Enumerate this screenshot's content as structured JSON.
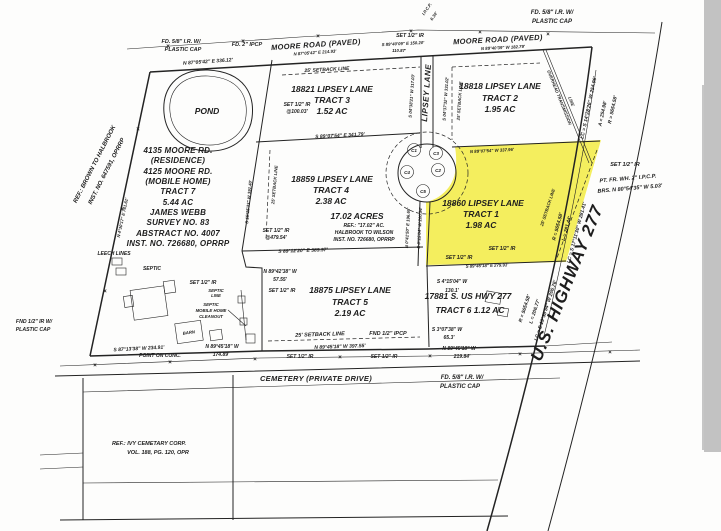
{
  "colors": {
    "highlight": "#f4ee5e",
    "ink": "#1d1d1d",
    "scan_edge": "#c2c2c2"
  },
  "glyphs": {
    "fence_x": "×"
  },
  "roads": {
    "moore_left": "MOORE ROAD (PAVED)",
    "moore_right": "MOORE ROAD (PAVED)",
    "lipsey_lane": "LIPSEY LANE",
    "cemetery": "CEMETERY (PRIVATE DRIVE)",
    "highway": "U.S. HIGHWAY 277",
    "transmission_1": "OVERHEAD TRANSMISSION",
    "transmission_2": "LINE"
  },
  "tracts": {
    "t1": {
      "l1": "18860 LIPSEY LANE",
      "l2": "TRACT 1",
      "l3": "1.98 AC"
    },
    "t2": {
      "l1": "18818 LIPSEY LANE",
      "l2": "TRACT 2",
      "l3": "1.95 AC"
    },
    "t3": {
      "l1": "18821 LIPSEY LANE",
      "l2": "TRACT 3",
      "l3": "1.52 AC"
    },
    "t4": {
      "l1": "18859 LIPSEY LANE",
      "l2": "TRACT 4",
      "l3": "2.38 AC"
    },
    "t5": {
      "l1": "18875 LIPSEY LANE",
      "l2": "TRACT 5",
      "l3": "2.19 AC"
    },
    "t6": {
      "l1": "17881 S. US HWY 277",
      "l2": "TRACT 6 1.12 AC"
    },
    "t7": {
      "lines": [
        "4135 MOORE RD.",
        "(RESIDENCE)",
        "4125 MOORE RD.",
        "(MOBILE HOME)",
        "TRACT 7",
        "5.44 AC",
        "JAMES WEBB",
        "SURVEY NO. 83",
        "ABSTRACT NO. 4007",
        "INST. NO. 726680, OPRRP"
      ]
    }
  },
  "area_note": {
    "acres": "17.02 ACRES",
    "l1": "REF.: \"17.02\" AC.",
    "l2": "HALBROOK TO WILSON",
    "l3": "INST. NO. 726680, OPRRP"
  },
  "features": {
    "pond": "POND",
    "leech": "LEECH LINES",
    "septic": "SEPTIC",
    "septic_line_1": "SEPTIC",
    "septic_line_2": "LINE",
    "cleanout_1": "SEPTIC",
    "cleanout_2": "MOBILE HOME",
    "cleanout_3": "CLEANOUT",
    "barn": "BARN",
    "point_on_conc": "POINT ON CONC."
  },
  "setbacks": {
    "s25": "25' SETBACK LINE"
  },
  "monuments": {
    "fd58": "FD. 5/8\" I.R. W/",
    "plastic_cap": "PLASTIC CAP",
    "fd2ipcp": "FD. 2\" IPCP",
    "set12": "SET 1/2\" IR",
    "at100": "@100.03'",
    "at479": "@479.54'",
    "fnd12": "FND 1/2\" IR W/",
    "fnd12ipcp": "FND 1/2\" IPCP",
    "pt_fr_1": "PT. FR. WH. 2\" I.P.C.P.",
    "pt_fr_2": "BRS. N 80°54'35\" W 5.03'",
    "ipcp_1": "I.P.C.P.",
    "ipcp_2": "6.34'"
  },
  "bearings": {
    "n870542_336": "N 87°05'42\" E  336.12'",
    "n870542_214": "N 87°05'42\" E  214.93'",
    "s894009_150": "S 89°40'09\" E  150.20'",
    "d11087": "110.87'",
    "n894039_182": "N 89°40'39\" W  182.79'",
    "n043017_761": "N 4°30'17\" E  761.61'",
    "s152533_391": "S 15°25'33\" W  391.40'",
    "s890754_341": "S 89°07'54\" E  341.79'",
    "n890754_337": "N 89°07'54\" W  337.96'",
    "s043821_317": "S 04°38'21\" W  317.03'",
    "s043732_331": "S 04°37'32\" W  331.02'",
    "s891220_389": "S 89°12'20\" E  389.97'",
    "n004150_196": "N 0°41'50\" E  196.65'",
    "s001504_200": "S 0°15'04\" W  200.94'",
    "s894518_279": "S 89°45'18\" E  279.91'",
    "s041504": "S 4°15'04\" W",
    "d1301": "130.1'",
    "s030738": "S 3°07'38\" W",
    "d653": "65.3'",
    "n894518": "N 89°45'18\" W",
    "d21984": "219.84'",
    "n894518_397": "N 89°45'18\" W  397.55'",
    "n894518_174": "N 89°45'18\" W",
    "d17489": "174.89'",
    "n894238": "N 89°42'38\" W",
    "d5755": "57.55'",
    "s871338_234": "S 87°13'38\" W  234.91'"
  },
  "curves": {
    "c1_lc": "LC = S 14°28'26\" W 254.96'",
    "c1_a": "A = 254.98'",
    "c1_r": "R = 5654.58'",
    "c2_r": "R = 5654.58'",
    "c2_l": "L = 281.44'",
    "c2_lc": "LC = S 17°11'30\" W 281.41'",
    "c3_r": "R = 5654.58'",
    "c3_l": "L = 206.77'",
    "c3_lc": "LC = S 19°38'54\" W 206.76'"
  },
  "notes": {
    "brown_1": "REF.: BROWN TO HALBROOK",
    "brown_2": "INST. NO. 647591, OPRRP",
    "ivy_1": "REF.: IVY CEMETARY CORP.",
    "ivy_2": "VOL. 188, PG. 120, OPR"
  },
  "culdesac": [
    "C1",
    "C3",
    "C4",
    "C2",
    "C5"
  ]
}
